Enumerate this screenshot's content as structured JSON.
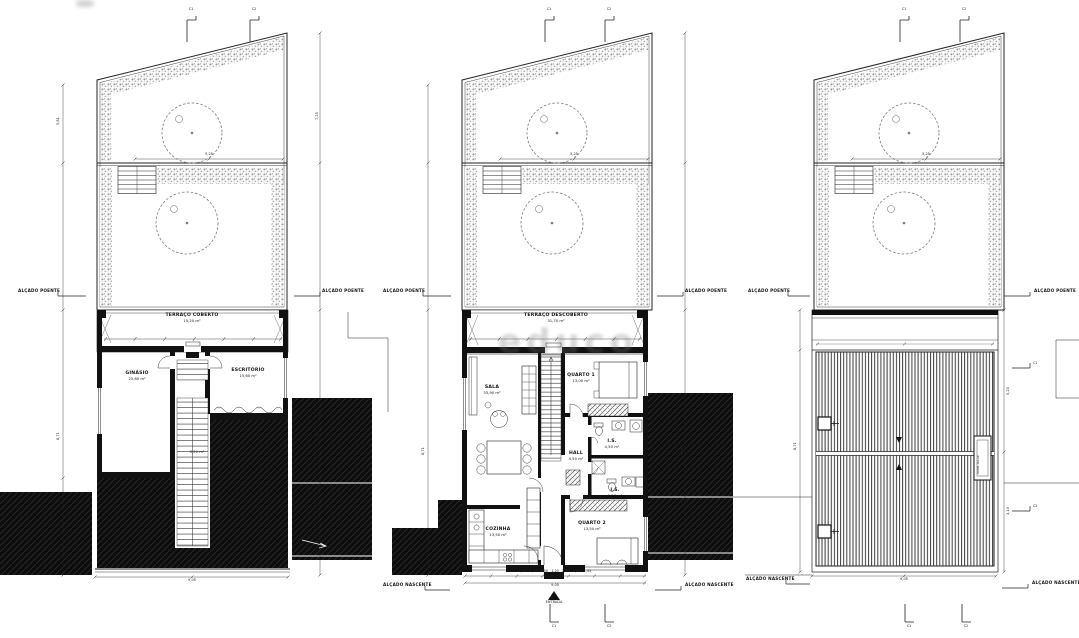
{
  "labels": {
    "alcado_poente": "ALÇADO POENTE",
    "alcado_nascente": "ALÇADO NASCENTE",
    "entrada": "ENTRADA",
    "c1": "C1",
    "c2": "C2",
    "watermark": "educo"
  },
  "panel1": {
    "terraco_name": "TERRAÇO COBERTO",
    "terraco_area": "15,20 m²",
    "ginasio_name": "GINÁSIO",
    "ginasio_area": "25,60 m²",
    "escritorio_name": "ESCRITÓRIO",
    "escritorio_area": "15,60 m²",
    "arrumos_area": "3,50 m²",
    "garden_dim": "5,25",
    "dim_bottom": "9,05",
    "dim_left_upper": "5,81",
    "dim_left_lower": "8,71",
    "dim_right_upper": "7,25",
    "dim_right_lower": "8,98"
  },
  "panel2": {
    "terraco_name": "TERRAÇO DESCOBERTO",
    "terraco_area": "31,70 m²",
    "sala_name": "SALA",
    "sala_area": "33,90 m²",
    "cozinha_name": "COZINHA",
    "cozinha_area": "13,50 m²",
    "quarto1_name": "QUARTO 1",
    "quarto1_area": "13,00 m²",
    "quarto2_name": "QUARTO 2",
    "quarto2_area": "13,50 m²",
    "is1_name": "I.S.",
    "is1_area": "4,50 m²",
    "is2_name": "I.S.",
    "is2_area": "5,00 m²",
    "hall_name": "HALL",
    "hall_area": "4,50 m²",
    "garden_dim": "5,25",
    "dims_bottom": "1,45   1,20   2,50   1,20   2,50   1,20   1,45",
    "dim_total": "9,05",
    "dim_left": "8,71",
    "dim_right": "8,98"
  },
  "panel3": {
    "garden_dim": "5,25",
    "roof_box": "PAINEL SOLAR",
    "dim_bottom": "9,05",
    "dim_left": "8,71",
    "dim_right_upper": "5,20",
    "dim_right_lower": "3,10"
  }
}
